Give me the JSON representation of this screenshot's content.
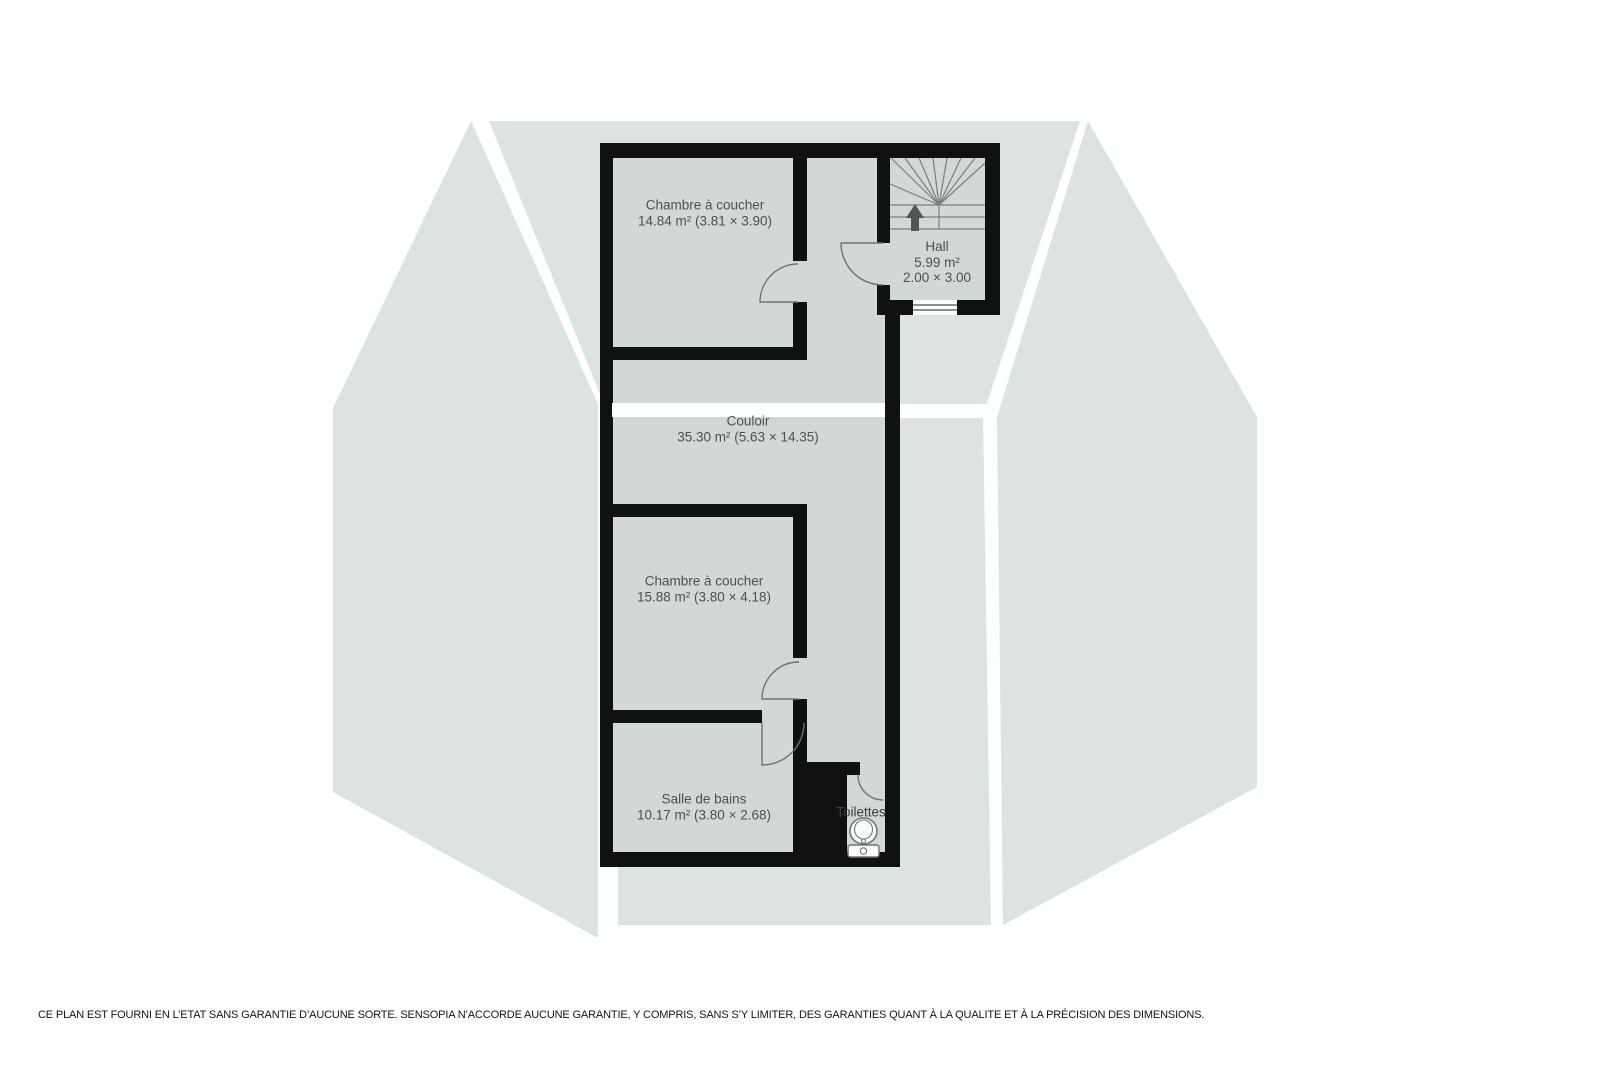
{
  "rooms": {
    "bedroom_top": {
      "label": "Chambre à coucher",
      "details": "14.84 m² (3.81 × 3.90)"
    },
    "hall": {
      "label": "Hall",
      "area": "5.99 m²",
      "dims": "2.00 × 3.00"
    },
    "corridor": {
      "label": "Couloir",
      "details": "35.30 m² (5.63 × 14.35)"
    },
    "bedroom_middle": {
      "label": "Chambre à coucher",
      "details": "15.88 m² (3.80 × 4.18)"
    },
    "bathroom": {
      "label": "Salle de bains",
      "details": "10.17 m² (3.80 × 2.68)"
    },
    "toilet": {
      "label": "Toilettes"
    }
  },
  "footer": {
    "disclaimer": "CE PLAN EST FOURNI EN L’ETAT SANS GARANTIE D’AUCUNE SORTE. SENSOPIA N’ACCORDE AUCUNE GARANTIE, Y COMPRIS, SANS S’Y LIMITER, DES GARANTIES QUANT À LA QUALITE ET À LA PRÉCISION DES DIMENSIONS."
  },
  "colors": {
    "roof_plane": "#dce3e0",
    "floor": "#d2d8d5",
    "wall": "#0f1211",
    "door_stroke": "#6b7471",
    "stair_stroke": "#7a807d",
    "label_text": "#4a524f",
    "arrow_fill": "#4f5653"
  }
}
